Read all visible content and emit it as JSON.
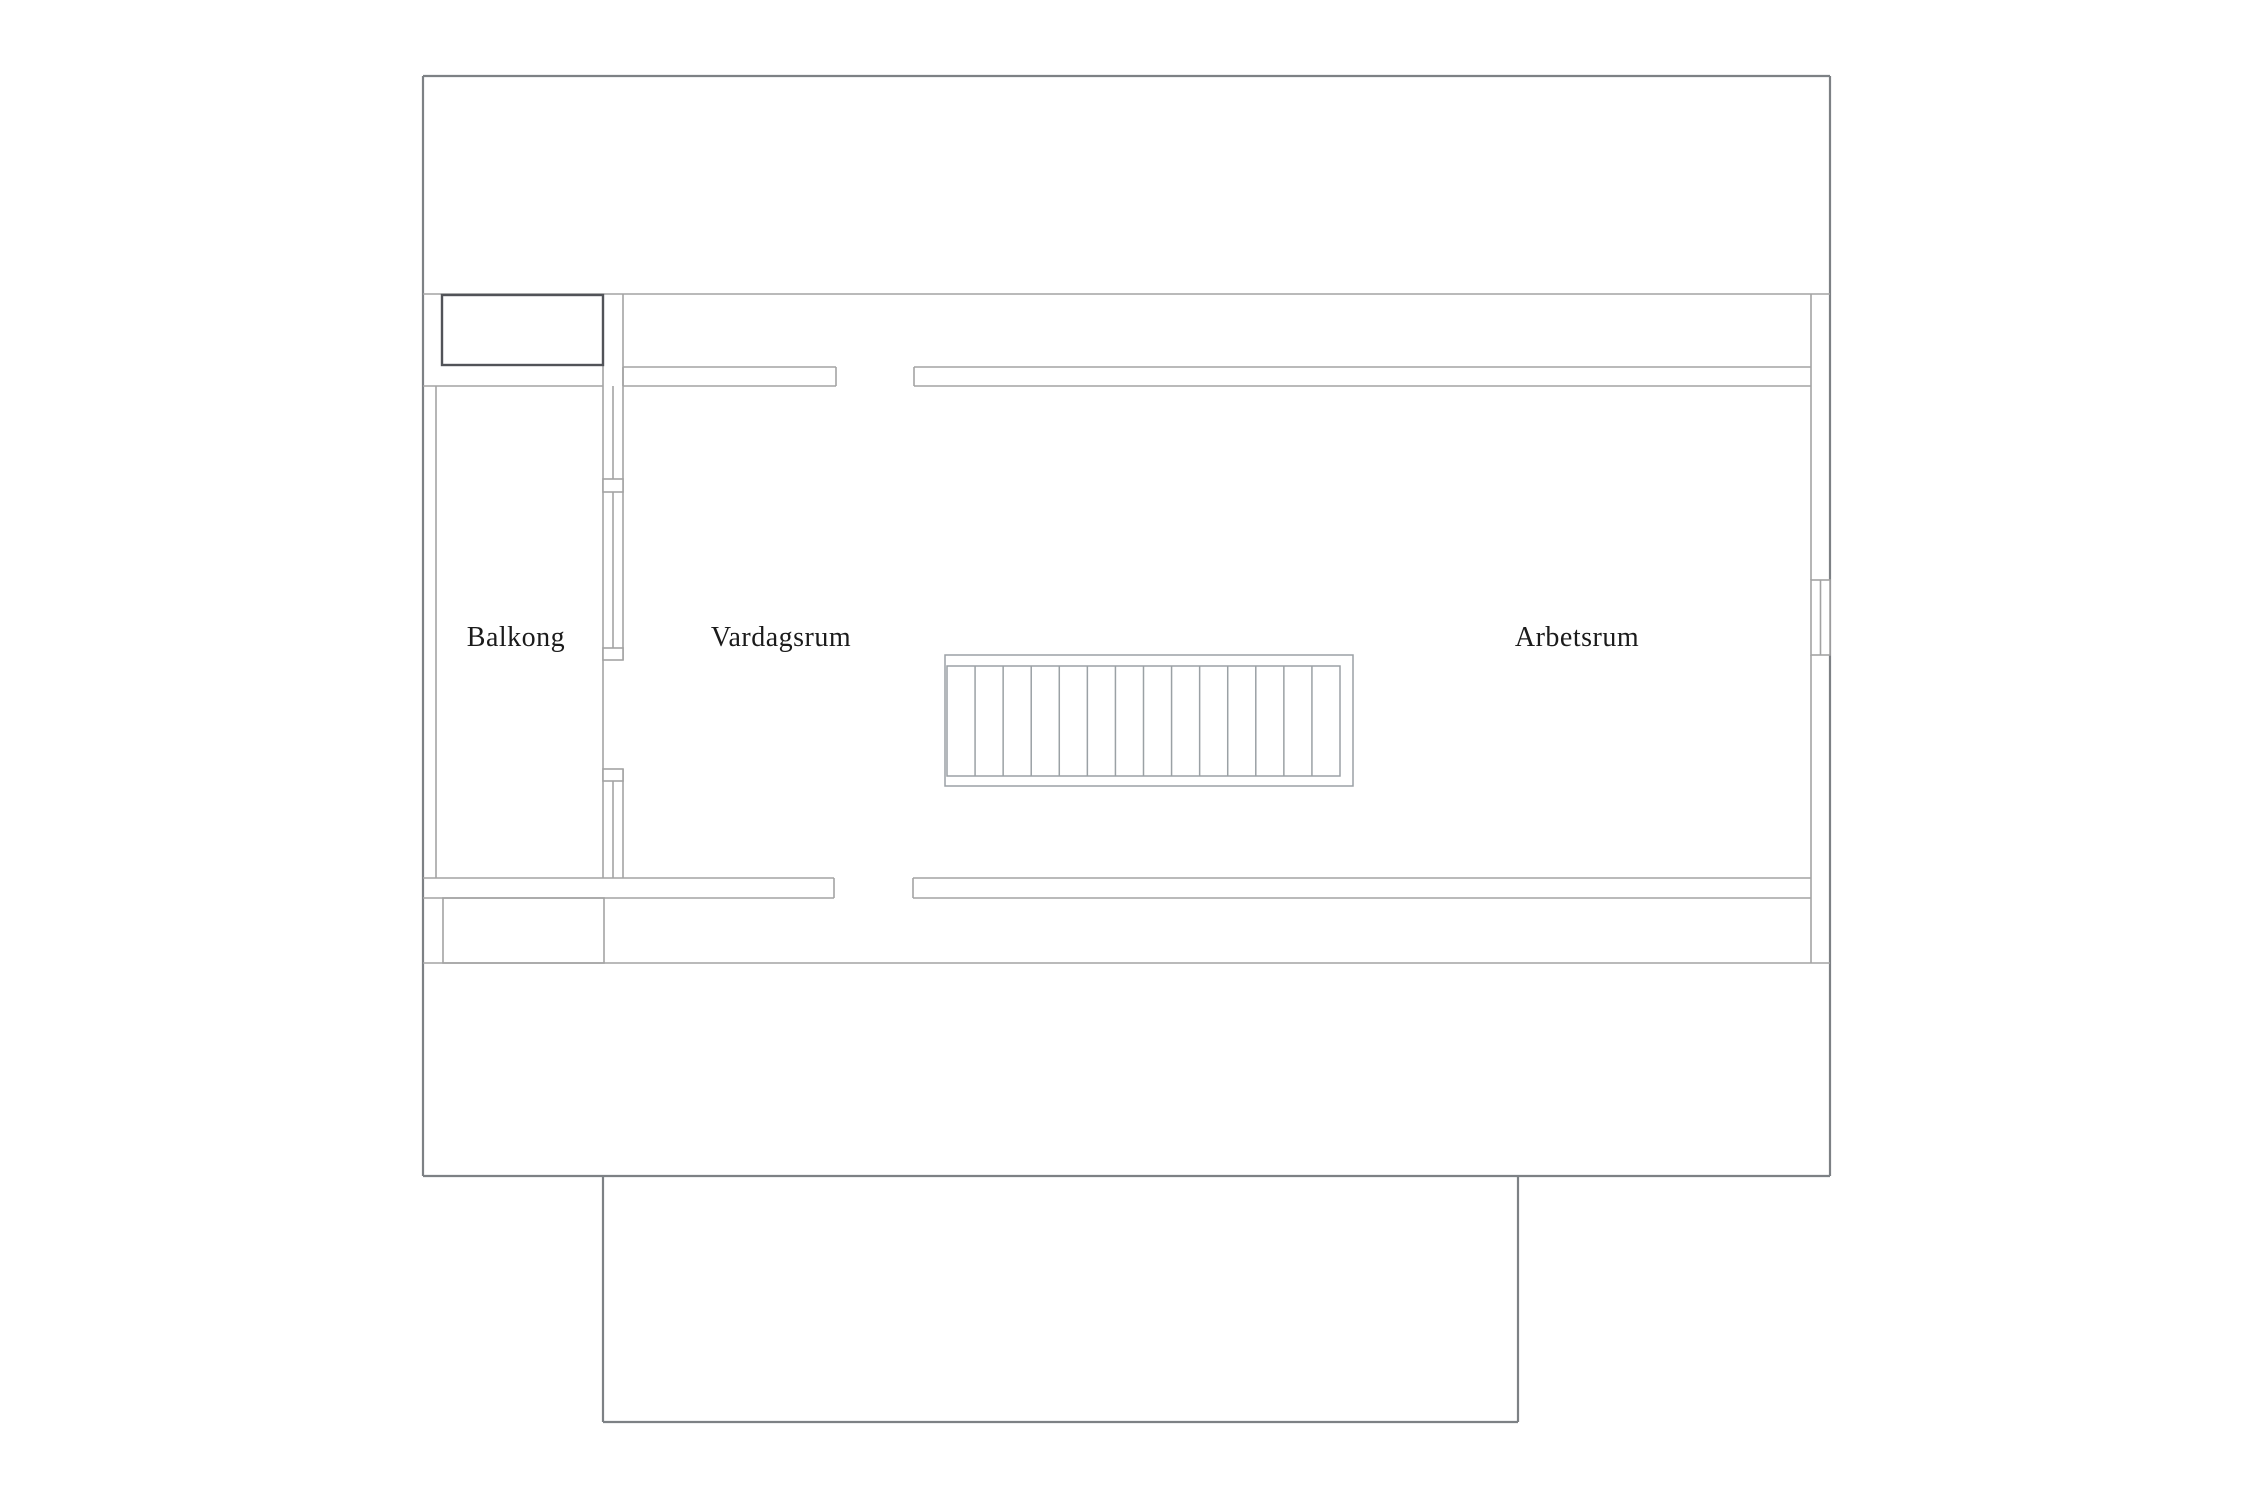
{
  "page": {
    "background": "#ffffff",
    "description": "Upper floor architectural plan, line drawing on white"
  },
  "plan": {
    "rooms": [
      {
        "id": "balkong",
        "label": "Balkong",
        "label_x": 516,
        "label_y": 646
      },
      {
        "id": "vardagsrum",
        "label": "Vardagsrum",
        "label_x": 781,
        "label_y": 646
      },
      {
        "id": "arbetsrum",
        "label": "Arbetsrum",
        "label_x": 1577,
        "label_y": 646
      }
    ],
    "staircase": {
      "treads": 14,
      "inner_x": 947,
      "inner_y": 666,
      "inner_width": 393,
      "inner_height": 110
    },
    "colors": {
      "outer_wall": "#7d8185",
      "inner_wall": "#a3a3a3",
      "chimney_dark": "#515358",
      "stair": "#9ba1a5",
      "text": "#1b1b1b",
      "background": "#ffffff"
    }
  }
}
